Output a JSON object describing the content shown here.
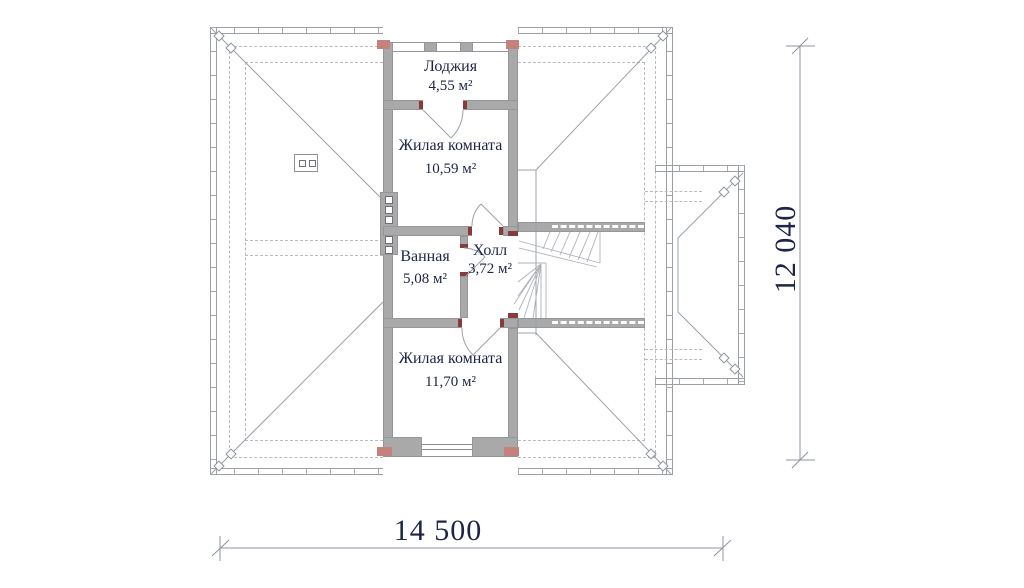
{
  "rooms": [
    {
      "id": "loggia",
      "name": "Лоджия",
      "area": "4,55 м²"
    },
    {
      "id": "living-top",
      "name": "Жилая комната",
      "area": "10,59 м²"
    },
    {
      "id": "bathroom",
      "name": "Ванная",
      "area": "5,08 м²"
    },
    {
      "id": "hall",
      "name": "Холл",
      "area": "3,72 м²"
    },
    {
      "id": "living-bottom",
      "name": "Жилая комната",
      "area": "11,70 м²"
    }
  ],
  "dimensions": {
    "horizontal": "14 500",
    "vertical": "12 040"
  },
  "colors": {
    "wall_gray": "#a9a9a9",
    "line_gray": "#9aa0a6",
    "corner_red": "#c5827c",
    "jamb_red": "#8b3a3a",
    "text_navy": "#1c2448"
  }
}
